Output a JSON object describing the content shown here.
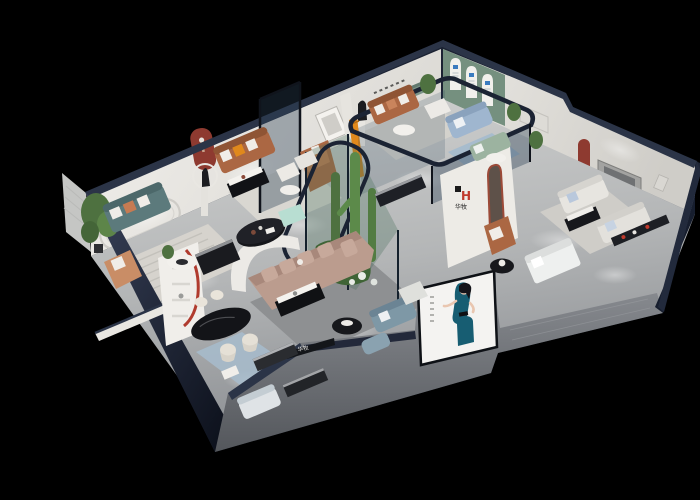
{
  "scene": {
    "kind": "3d-isometric-cutaway-render",
    "description": "Aerial cutaway 3D rendering of a furniture showroom with multiple styled room vignettes, floating on a pure black background",
    "background": "#000000"
  },
  "brand": {
    "logo_letter": "H",
    "name": "华牧"
  },
  "signage": {
    "feature_wall_logo_letter": "H",
    "feature_wall_name": "华牧",
    "storefront_name": "华牧",
    "poster_subject": "woman in teal evening dress"
  },
  "palette": {
    "background": "#000000",
    "rim": "#2b3447",
    "rimDark": "#1c2333",
    "wall": "#ece9e4",
    "wallShade": "#d8d5d0",
    "greenWall": "#75907f",
    "redAccent": "#8e3a30",
    "brandRed": "#c03a2c",
    "facade": "#83868b",
    "tealSofa": "#5c7a7c",
    "caramelSofa": "#ab6743",
    "blushSofa": "#bb9c8e",
    "lightBlueSofa": "#9fb6cf",
    "sageSofa": "#9cb3a0",
    "slateSofa": "#7e98a6",
    "whiteSofa": "#e7e5e0",
    "orangeAccent": "#e0891c",
    "plant": "#4e7140",
    "blackFurniture": "#17181c",
    "glass": "rgba(44,66,86,0.38)",
    "posterBg": "#f4f3f1",
    "posterDress": "#175d72",
    "mint": "#b8ded2",
    "rug": "#d6d3cd",
    "blueRug": "#a7bccd",
    "hallRug": "#8e9092"
  },
  "rooms": [
    {
      "id": "lounge-teal",
      "label": "teal sofa lounge with rounded wall molding"
    },
    {
      "id": "lounge-caramel",
      "label": "caramel leather sofa lounge with red arch niche and sculpture"
    },
    {
      "id": "lounge-top-right",
      "label": "caramel sofa lounge with green arched display wall"
    },
    {
      "id": "glass-room",
      "label": "glass-walled room with light blue and sage sofas"
    },
    {
      "id": "suite-right",
      "label": "white sofa suite with red arch niche and TV panel"
    },
    {
      "id": "terrarium",
      "label": "glass terrarium with cacti"
    },
    {
      "id": "hall-center",
      "label": "central hall with blush sectional and curved white partition"
    },
    {
      "id": "dining",
      "label": "black oval dining table with cream chairs and red curved shelf"
    },
    {
      "id": "storefront",
      "label": "gray facade with brand signage and fashion poster"
    }
  ]
}
